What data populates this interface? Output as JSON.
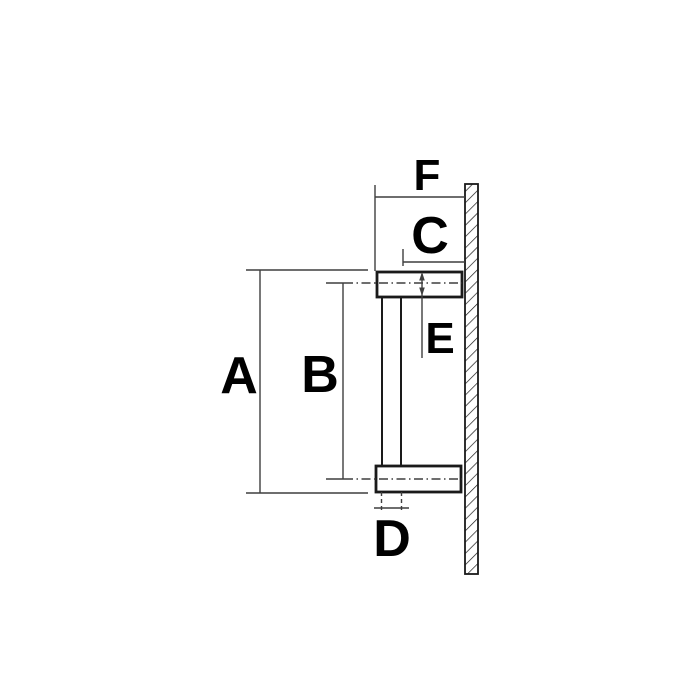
{
  "diagram": {
    "colors": {
      "background": "#ffffff",
      "outline": "#1a1a1a",
      "dimension": "#3f3f3f",
      "text": "#000000"
    },
    "labels": {
      "a": "A",
      "b": "B",
      "c": "C",
      "d": "D",
      "e": "E",
      "f": "F"
    }
  }
}
